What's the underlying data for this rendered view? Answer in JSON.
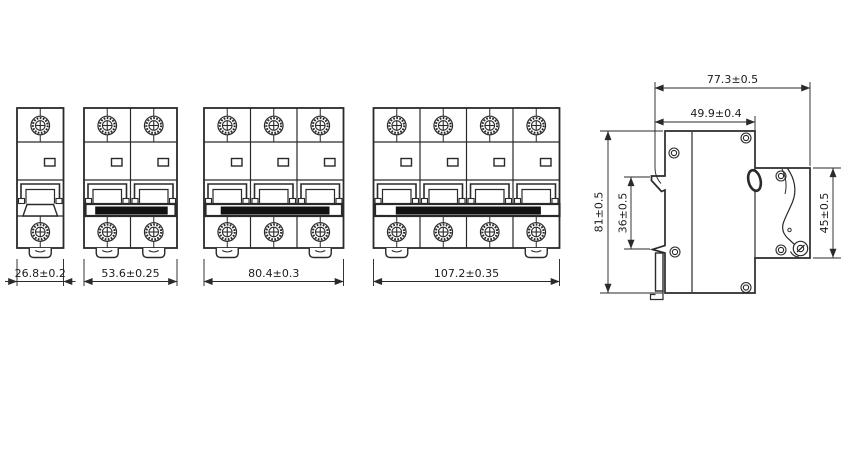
{
  "drawing": {
    "front_views": [
      {
        "name": "1-pole",
        "poles": 1,
        "width_label": "26.8±0.2"
      },
      {
        "name": "2-pole",
        "poles": 2,
        "width_label": "53.6±0.25"
      },
      {
        "name": "3-pole",
        "poles": 3,
        "width_label": "80.4±0.3"
      },
      {
        "name": "4-pole",
        "poles": 4,
        "width_label": "107.2±0.35"
      }
    ],
    "side_view": {
      "labels": {
        "overall_depth": "77.3±0.5",
        "upper_depth": "49.9±0.4",
        "overall_height": "81±0.5",
        "din_recess_height": "36±0.5",
        "front_section_height": "45±0.5"
      }
    },
    "icons": {
      "screw": "knurled-circle-with-cross",
      "rivet": "double-circle",
      "din_clip": "rounded-tab",
      "lockout_hole": "tilted-oval",
      "toggle_lever": "wavy-profile-with-pivot"
    },
    "colors": {
      "line": "#2a2a2a",
      "fill": "#121212",
      "background": "#ffffff"
    }
  }
}
